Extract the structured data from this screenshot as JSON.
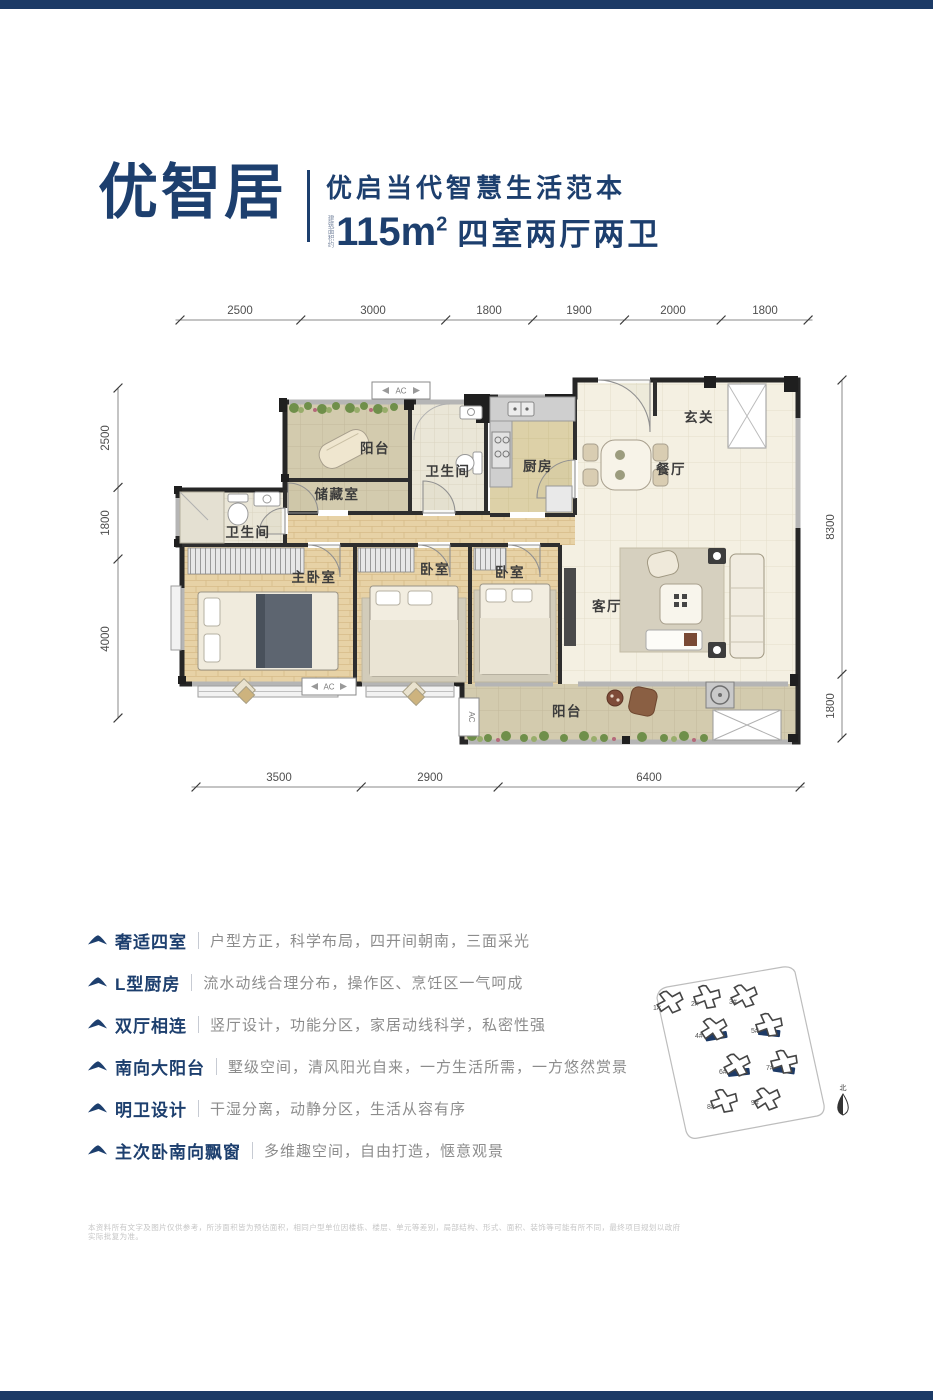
{
  "colors": {
    "navy": "#1d3f6e",
    "bar_navy": "#1c3a66",
    "wall": "#262626",
    "floor_tile": "#f4f0e2",
    "floor_wood": "#e7d2a6",
    "balcony_tile": "#d3cbae"
  },
  "header": {
    "title": "优智居",
    "slogan": "优启当代智慧生活范本",
    "area_prefix": "建筑面积约",
    "area_value": "115m",
    "area_sup": "2",
    "area_rooms": "四室两厅两卫"
  },
  "floorplan": {
    "ac_label": "AC",
    "dims_top": [
      "2500",
      "3000",
      "1800",
      "1900",
      "2000",
      "1800"
    ],
    "dims_bottom": [
      "3500",
      "2900",
      "6400"
    ],
    "dims_left": [
      "2500",
      "1800",
      "4000"
    ],
    "dims_right": [
      "8300",
      "1800"
    ],
    "rooms": {
      "balcony_top": "阳台",
      "bath_top": "卫生间",
      "kitchen": "厨房",
      "entry": "玄关",
      "dining": "餐厅",
      "storage": "储藏室",
      "bath_left": "卫生间",
      "master": "主卧室",
      "bedroom_mid": "卧室",
      "bedroom_right": "卧室",
      "living": "客厅",
      "balcony_bottom": "阳台"
    }
  },
  "features": [
    {
      "label": "奢适四室",
      "desc": "户型方正，科学布局，四开间朝南，三面采光"
    },
    {
      "label": "L型厨房",
      "desc": "流水动线合理分布，操作区、烹饪区一气呵成"
    },
    {
      "label": "双厅相连",
      "desc": "竖厅设计，功能分区，家居动线科学，私密性强"
    },
    {
      "label": "南向大阳台",
      "desc": "墅级空间，清风阳光自来，一方生活所需，一方悠然赏景"
    },
    {
      "label": "明卫设计",
      "desc": "干湿分离，动静分区，生活从容有序"
    },
    {
      "label": "主次卧南向飘窗",
      "desc": "多维趣空间，自由打造，惬意观景"
    }
  ],
  "sitemap": {
    "buildings": [
      "1#",
      "2#",
      "3#",
      "4#",
      "5#",
      "6#",
      "7#",
      "8#",
      "9#"
    ],
    "north_label": "北"
  },
  "disclaimer": "本资料所有文字及图片仅供参考，所涉面积皆为预估面积，相同户型单位因楼栋、楼层、单元等差别，局部结构、形式、面积、装饰等可能有所不同，最终项目规划以政府实际批复为准。"
}
